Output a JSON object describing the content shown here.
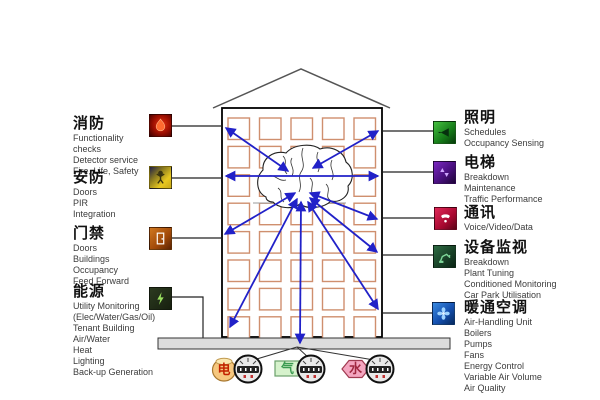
{
  "systems": {
    "left": [
      {
        "title": "消防",
        "icon": "fire-icon",
        "items": [
          "Functionality",
          "checks",
          "Detector service",
          "Fire, Life, Safety"
        ]
      },
      {
        "title": "安防",
        "icon": "security-person-icon",
        "items": [
          "Doors",
          "PIR",
          "Integration"
        ]
      },
      {
        "title": "门禁",
        "icon": "door-access-icon",
        "items": [
          "Doors",
          "Buildings",
          "Occupancy",
          "Feed Forward"
        ]
      },
      {
        "title": "能源",
        "icon": "energy-meter-icon",
        "items": [
          "Utility Monitoring",
          "(Elec/Water/Gas/Oil)",
          "Tenant Building",
          "Air/Water",
          "Heat",
          "Lighting",
          "Back-up Generation"
        ]
      }
    ],
    "right": [
      {
        "title": "照明",
        "icon": "lighting-beam-icon",
        "items": [
          "Schedules",
          "Occupancy Sensing"
        ]
      },
      {
        "title": "电梯",
        "icon": "elevator-icon",
        "items": [
          "Breakdown",
          "Maintenance",
          "Traffic Performance"
        ]
      },
      {
        "title": "通讯",
        "icon": "communication-icon",
        "items": [
          "Voice/Video/Data"
        ]
      },
      {
        "title": "设备监视",
        "icon": "equipment-monitoring-icon",
        "items": [
          "Breakdown",
          "Plant Tuning",
          "Conditioned Monitoring",
          "Car Park Utilisation"
        ]
      },
      {
        "title": "暖通空调",
        "icon": "hvac-fan-icon",
        "items": [
          "Air-Handling Unit",
          "Boilers",
          "Pumps",
          "Fans",
          "Energy Control",
          "Variable Air Volume",
          "Air Quality"
        ]
      }
    ]
  },
  "meters": [
    {
      "label": "电",
      "shape": "circle-coin",
      "fill": "#f6c77e",
      "text_color": "#c22200"
    },
    {
      "label": "气",
      "shape": "rectangle",
      "fill": "#d6f2cc",
      "text_color": "#3a9a50"
    },
    {
      "label": "水",
      "shape": "hexagon",
      "fill": "#f4a6c0",
      "text_color": "#a02840"
    }
  ],
  "colors": {
    "arrow": "#2121c8",
    "window": "#cf8f6e",
    "ground_bar": "#dcdcdc"
  },
  "building": {
    "windows_columns": 5,
    "windows_rows": 8
  }
}
